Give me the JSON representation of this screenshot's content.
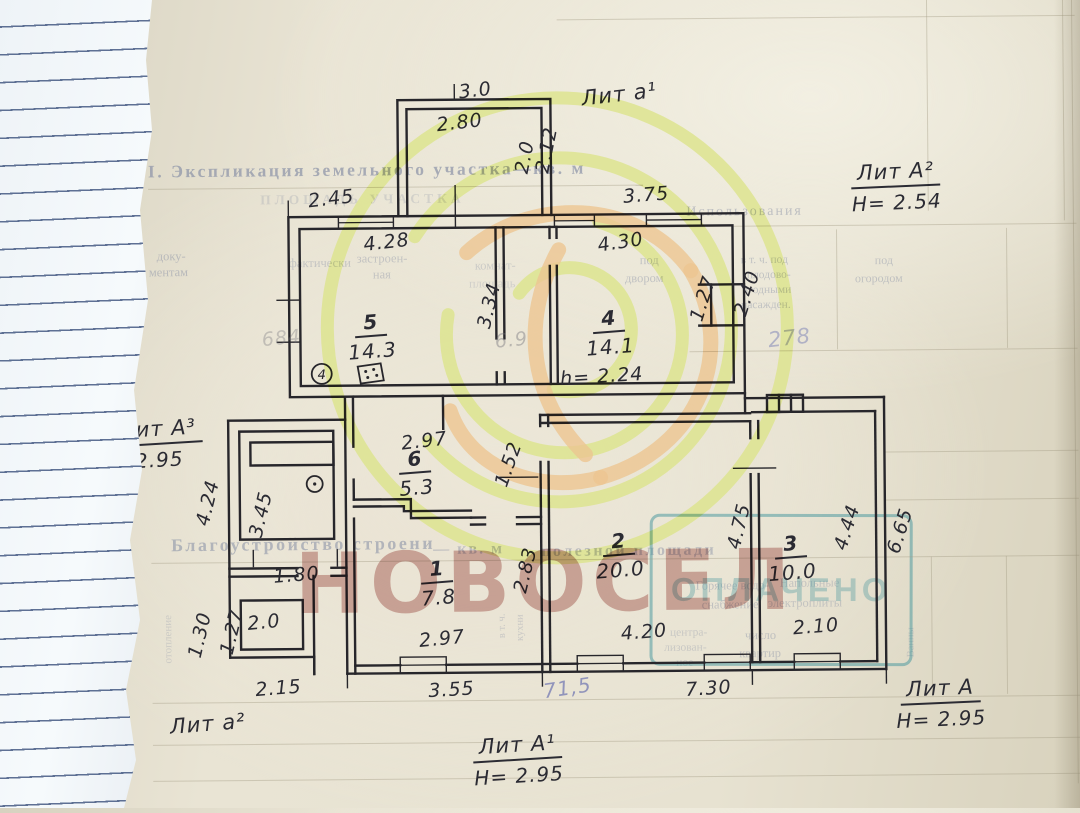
{
  "colors": {
    "ink": "#27262b",
    "hand": "#2b2b33",
    "printed": "#8d94a8",
    "watermark_yellow": "#dde48f",
    "watermark_orange": "#ecbf85",
    "watermark_letters": "#a45e54",
    "stamp_teal": "#40949c",
    "paper": "#e7e2d1"
  },
  "watermark": {
    "text": "НОВОСЕЛ"
  },
  "stamp": {
    "text": "ОПЛАЧЕНО"
  },
  "printed": {
    "items": [
      {
        "t": "I. Экспликация земельного участка—кв. м",
        "x": 150,
        "y": 158,
        "s": 17.5,
        "ls": 2.5,
        "o": 0.72,
        "b": 1
      },
      {
        "t": "ПЛОЩАДЬ УЧАСТКА",
        "x": 262,
        "y": 190,
        "s": 13.5,
        "ls": 4,
        "o": 0.26,
        "b": 1
      },
      {
        "t": "доку-",
        "x": 158,
        "y": 246,
        "s": 12.5,
        "o": 0.5
      },
      {
        "t": "ментам",
        "x": 150,
        "y": 262,
        "s": 12.5,
        "o": 0.5
      },
      {
        "t": "фактически",
        "x": 290,
        "y": 254,
        "s": 12.5,
        "o": 0.4
      },
      {
        "t": "застроен-",
        "x": 358,
        "y": 250,
        "s": 12.5,
        "o": 0.42
      },
      {
        "t": "ная",
        "x": 374,
        "y": 266,
        "s": 12.5,
        "o": 0.42
      },
      {
        "t": "комнат-",
        "x": 476,
        "y": 258,
        "s": 12.5,
        "o": 0.33
      },
      {
        "t": "площадь",
        "x": 470,
        "y": 276,
        "s": 12.5,
        "o": 0.28
      },
      {
        "t": "под",
        "x": 641,
        "y": 254,
        "s": 12.5,
        "o": 0.45
      },
      {
        "t": "двором",
        "x": 626,
        "y": 272,
        "s": 12.5,
        "o": 0.45
      },
      {
        "t": "Использования",
        "x": 688,
        "y": 206,
        "s": 14,
        "ls": 2,
        "o": 0.5
      },
      {
        "t": "в т. ч. под",
        "x": 742,
        "y": 256,
        "s": 11.5,
        "o": 0.45
      },
      {
        "t": "плодово-",
        "x": 748,
        "y": 271,
        "s": 11.5,
        "o": 0.45
      },
      {
        "t": "ягодными",
        "x": 744,
        "y": 286,
        "s": 11.5,
        "o": 0.45
      },
      {
        "t": "насажден.",
        "x": 742,
        "y": 301,
        "s": 11.5,
        "o": 0.45
      },
      {
        "t": "под",
        "x": 876,
        "y": 256,
        "s": 12,
        "o": 0.45
      },
      {
        "t": "огородом",
        "x": 856,
        "y": 274,
        "s": 12,
        "o": 0.45
      },
      {
        "t": "Благоустройство строени",
        "x": 170,
        "y": 532,
        "s": 18,
        "ls": 2.5,
        "o": 0.6,
        "b": 1
      },
      {
        "t": "— кв. м",
        "x": 432,
        "y": 540,
        "s": 16,
        "ls": 2,
        "o": 0.5,
        "b": 1
      },
      {
        "t": "полезной площади",
        "x": 540,
        "y": 543,
        "s": 16,
        "ls": 2.5,
        "o": 0.5,
        "b": 1
      },
      {
        "t": "Горячее водо-",
        "x": 694,
        "y": 580,
        "s": 12.5,
        "o": 0.45
      },
      {
        "t": "снабжение",
        "x": 700,
        "y": 599,
        "s": 12.5,
        "o": 0.45
      },
      {
        "t": "Напольные",
        "x": 778,
        "y": 578,
        "s": 12.5,
        "o": 0.4
      },
      {
        "t": "электроплиты",
        "x": 766,
        "y": 598,
        "s": 12.5,
        "o": 0.4
      },
      {
        "t": "центра-",
        "x": 668,
        "y": 628,
        "s": 11.5,
        "o": 0.35
      },
      {
        "t": "лизован-",
        "x": 662,
        "y": 643,
        "s": 11.5,
        "o": 0.35
      },
      {
        "t": "ное",
        "x": 674,
        "y": 658,
        "s": 11.5,
        "o": 0.35
      },
      {
        "t": "число",
        "x": 743,
        "y": 630,
        "s": 12.5,
        "o": 0.45
      },
      {
        "t": "квартир",
        "x": 737,
        "y": 648,
        "s": 12.5,
        "o": 0.45
      },
      {
        "t": "в т. ч.",
        "x": 488,
        "y": 620,
        "s": 10.5,
        "o": 0.36,
        "r": -90
      },
      {
        "t": "кухни",
        "x": 505,
        "y": 622,
        "s": 10.5,
        "o": 0.36,
        "r": -90
      },
      {
        "t": "Ванны",
        "x": 894,
        "y": 640,
        "s": 10.5,
        "o": 0.33,
        "r": -90
      },
      {
        "t": "отопление",
        "x": 142,
        "y": 630,
        "s": 11,
        "o": 0.3,
        "r": -90
      }
    ]
  },
  "plan": {
    "symbols": {
      "circled": "4"
    },
    "walls": [
      "M400 215 V99 H553 V215",
      "M409 215 V108 H544 V215",
      "M290 215 H745 V395 H290 Z",
      "M301 227 H734 V384 H301 Z",
      "M497 227 V338",
      "M505 227 V338",
      "M497 372 V384",
      "M505 372 V384",
      "M551 227 V238",
      "M558 227 V238",
      "M551 266 V384",
      "M558 266 V384",
      "M712 286 H734 V327 H712 Z",
      "M700 286 H712",
      "M700 327 H712",
      "M734 286 H745",
      "M734 327 H745",
      "M228 418 H345",
      "M228 418 V655",
      "M239 429 H333 V537 H239 Z",
      "M250 440 H333 V463 H250 Z",
      "M228 566 H296",
      "M330 566 H345",
      "M228 574 H296",
      "M330 574 H345",
      "M239 598 H301 V647 H239 Z",
      "M312 574 V672",
      "M228 655 H312",
      "M312 655 V672",
      "M345 395 V672",
      "M353 395 V445",
      "M353 478 V498",
      "M353 517 V672",
      "M353 498 H410 V517 H470",
      "M353 505 H403 V510 H470",
      "M470 517 H484",
      "M516 517 H540",
      "M470 524 H484",
      "M516 524 H540",
      "M443 395 V428",
      "M540 415 V426",
      "M540 462 V672",
      "M548 415 V426",
      "M548 462 V672",
      "M540 415 H750",
      "M540 423 H750",
      "M745 395 V415",
      "M745 400 H884",
      "M752 414 H875",
      "M767 397 H803 V414 H767 Z",
      "M779 397 V414",
      "M791 397 V414",
      "M884 400 V672",
      "M875 414 V664",
      "M750 423 V440",
      "M750 476 V664",
      "M758 423 V440",
      "M758 476 V664",
      "M345 672 H884",
      "M353 664 H398",
      "M444 664 H575",
      "M621 664 H702",
      "M748 664 H792",
      "M838 664 H875"
    ],
    "thin": [
      "M457 84 V99",
      "M457 185 V215",
      "M457 215 V227",
      "M278 298 H301",
      "M278 340 H301",
      "M400 199 V215",
      "M290 199 V215",
      "M497 477 H537",
      "M733 470 H775",
      "M252 548 V564",
      "M336 548 V564",
      "M345 672 V686",
      "M540 672 V686",
      "M750 672 V686",
      "M884 672 V686"
    ],
    "windows": [
      [
        340,
        215,
        55,
        12
      ],
      [
        556,
        215,
        40,
        12
      ],
      [
        648,
        215,
        55,
        12
      ],
      [
        398,
        656,
        46,
        16
      ],
      [
        575,
        656,
        46,
        16
      ],
      [
        702,
        656,
        46,
        16
      ],
      [
        792,
        656,
        46,
        16
      ]
    ],
    "grid": [
      [
        560,
        20,
        1078,
        20
      ],
      [
        150,
        186,
        645,
        186
      ],
      [
        648,
        228,
        1078,
        228
      ],
      [
        838,
        232,
        838,
        352
      ],
      [
        1008,
        232,
        1008,
        352
      ],
      [
        690,
        353,
        1078,
        353
      ],
      [
        930,
        2,
        930,
        214
      ],
      [
        1075,
        2,
        1075,
        788
      ],
      [
        1066,
        0,
        1066,
        225
      ],
      [
        884,
        455,
        1078,
        455
      ],
      [
        884,
        503,
        1078,
        503
      ],
      [
        150,
        560,
        1078,
        560
      ],
      [
        930,
        560,
        930,
        698
      ],
      [
        1005,
        560,
        1005,
        698
      ],
      [
        150,
        700,
        1078,
        700
      ],
      [
        150,
        742,
        1078,
        742
      ],
      [
        150,
        778,
        1078,
        778
      ]
    ],
    "dims": [
      {
        "t": "3.0",
        "x": 478,
        "y": 90,
        "r": -6
      },
      {
        "t": "2.80",
        "x": 462,
        "y": 122,
        "r": -6
      },
      {
        "t": "2.0",
        "x": 527,
        "y": 157,
        "r": -78
      },
      {
        "t": "2.12",
        "x": 549,
        "y": 150,
        "r": -78
      },
      {
        "t": "2.45",
        "x": 333,
        "y": 197,
        "r": -6
      },
      {
        "t": "3.75",
        "x": 648,
        "y": 196,
        "r": -4
      },
      {
        "t": "4.28",
        "x": 388,
        "y": 241,
        "r": -6
      },
      {
        "t": "4.30",
        "x": 622,
        "y": 243,
        "r": -8
      },
      {
        "t": "3.34",
        "x": 490,
        "y": 305,
        "r": -76
      },
      {
        "t": "h= 2.24",
        "x": 602,
        "y": 377,
        "r": -3
      },
      {
        "t": "1.27",
        "x": 704,
        "y": 300,
        "r": -72
      },
      {
        "t": "2.40",
        "x": 748,
        "y": 295,
        "r": -72
      },
      {
        "t": "4.24",
        "x": 207,
        "y": 500,
        "r": -76
      },
      {
        "t": "3.45",
        "x": 260,
        "y": 512,
        "r": -76
      },
      {
        "t": "1.80",
        "x": 295,
        "y": 573,
        "r": -4
      },
      {
        "t": "2.0",
        "x": 262,
        "y": 620,
        "r": -5
      },
      {
        "t": "1.30",
        "x": 198,
        "y": 632,
        "r": -76
      },
      {
        "t": "1.27",
        "x": 230,
        "y": 629,
        "r": -76
      },
      {
        "t": "2.15",
        "x": 276,
        "y": 686,
        "r": -4
      },
      {
        "t": "2.97",
        "x": 424,
        "y": 440,
        "r": -6
      },
      {
        "t": "1.52",
        "x": 508,
        "y": 464,
        "r": -70
      },
      {
        "t": "2.83",
        "x": 524,
        "y": 570,
        "r": -76
      },
      {
        "t": "2.97",
        "x": 440,
        "y": 638,
        "r": -5
      },
      {
        "t": "3.55",
        "x": 449,
        "y": 689,
        "r": -3
      },
      {
        "t": "4.20",
        "x": 642,
        "y": 633,
        "r": -4
      },
      {
        "t": "4.75",
        "x": 738,
        "y": 528,
        "r": -76
      },
      {
        "t": "2.10",
        "x": 814,
        "y": 629,
        "r": -4
      },
      {
        "t": "4.44",
        "x": 846,
        "y": 530,
        "r": -72
      },
      {
        "t": "6.65",
        "x": 899,
        "y": 534,
        "r": -72
      },
      {
        "t": "7.30",
        "x": 706,
        "y": 690,
        "r": -3
      }
    ],
    "rooms": [
      {
        "n": "5",
        "a": "14.3",
        "x": 372,
        "y": 335
      },
      {
        "n": "4",
        "a": "14.1",
        "x": 610,
        "y": 333
      },
      {
        "n": "6",
        "a": "5.3",
        "x": 415,
        "y": 472
      },
      {
        "n": "1",
        "a": "7.8",
        "x": 436,
        "y": 582
      },
      {
        "n": "2",
        "a": "20.0",
        "x": 618,
        "y": 556
      },
      {
        "n": "3",
        "a": "10.0",
        "x": 790,
        "y": 560
      }
    ],
    "litera": [
      {
        "t": "Лит а¹",
        "x": 622,
        "y": 96,
        "r": -6,
        "u": 0
      },
      {
        "t": "Лит А²",
        "sub": "Н= 2.54",
        "x": 898,
        "y": 190,
        "r": -2,
        "u": 1
      },
      {
        "t": "Лит А³",
        "sub": "2.95",
        "x": 158,
        "y": 441,
        "r": -3,
        "u": 1
      },
      {
        "t": "Лит а²",
        "x": 205,
        "y": 722,
        "r": -4,
        "u": 0
      },
      {
        "t": "Лит А¹",
        "sub": "Н= 2.95",
        "x": 515,
        "y": 760,
        "r": -3,
        "u": 1
      },
      {
        "t": "Лит А",
        "sub": "Н= 2.95",
        "x": 938,
        "y": 707,
        "r": -2,
        "u": 1
      }
    ],
    "pencil": [
      {
        "t": "684",
        "x": 282,
        "y": 336,
        "r": -5,
        "c": "#6b6b75",
        "o": 0.32,
        "s": 19
      },
      {
        "t": "6.9",
        "x": 512,
        "y": 340,
        "r": -5,
        "c": "#6b6b75",
        "o": 0.4,
        "s": 19
      },
      {
        "t": "278",
        "x": 790,
        "y": 340,
        "r": -6,
        "c": "#8288b8",
        "o": 0.55,
        "s": 21
      },
      {
        "t": "71,5",
        "x": 565,
        "y": 688,
        "r": -8,
        "c": "#7b80b4",
        "o": 0.8,
        "s": 20
      }
    ]
  }
}
